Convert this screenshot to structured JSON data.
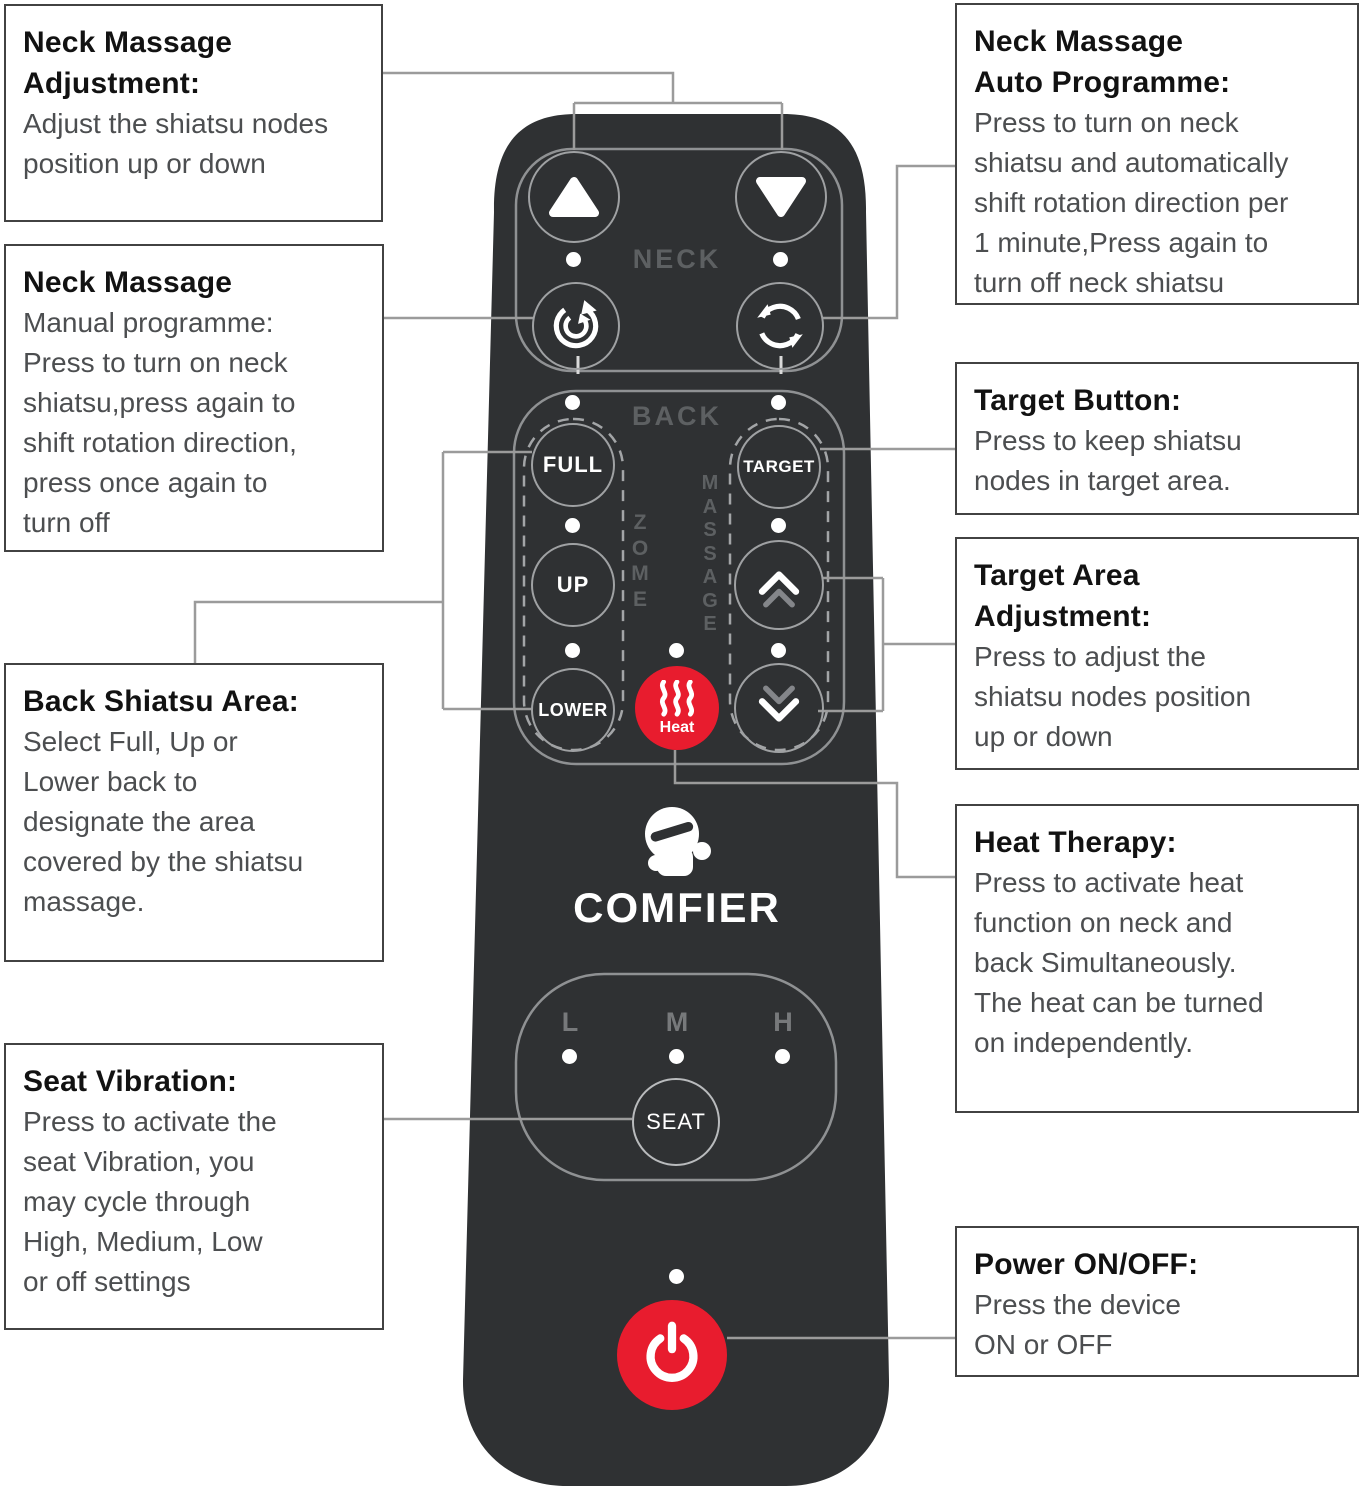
{
  "callouts": {
    "neck_adjustment": {
      "title": "Neck Massage\nAdjustment:",
      "body": "Adjust the shiatsu nodes\nposition up or down"
    },
    "neck_manual": {
      "title": "Neck Massage",
      "body": "Manual programme:\nPress to turn on neck\nshiatsu,press again to\nshift rotation direction,\npress once again to\nturn off"
    },
    "back_shiatsu": {
      "title": "Back Shiatsu Area:",
      "body": "Select Full, Up or\nLower back to\ndesignate the area\ncovered by the shiatsu\nmassage."
    },
    "seat_vibration": {
      "title": "Seat Vibration:",
      "body": "Press to activate the\nseat Vibration, you\nmay cycle through\nHigh, Medium, Low\nor off settings"
    },
    "neck_auto": {
      "title": "Neck Massage\nAuto Programme:",
      "body": "Press to turn on neck\nshiatsu and automatically\nshift rotation direction per\n1 minute,Press again to\nturn off neck shiatsu"
    },
    "target_button": {
      "title": "Target Button:",
      "body": "Press to keep shiatsu\nnodes in target area."
    },
    "target_area": {
      "title": "Target Area\nAdjustment:",
      "body": "Press to adjust the\nshiatsu nodes position\nup or down"
    },
    "heat_therapy": {
      "title": "Heat Therapy:",
      "body": "Press to activate heat\nfunction on neck and\nback Simultaneously.\nThe heat can be turned\non independently."
    },
    "power": {
      "title": "Power ON/OFF:",
      "body": "Press the device\nON or OFF"
    }
  },
  "remote": {
    "brand": "COMFIER",
    "neck_label": "NECK",
    "back_label": "BACK",
    "zone_vertical": "Z\nO\nM\nE",
    "massage_vertical": "M\nA\nS\nS\nA\nG\nE",
    "buttons": {
      "full": "FULL",
      "target": "TARGET",
      "up": "UP",
      "lower": "LOWER",
      "heat": "Heat",
      "seat": "SEAT"
    },
    "seat_levels": {
      "low": "L",
      "medium": "M",
      "high": "H"
    }
  },
  "colors": {
    "remote_body": "#2f3133",
    "accent_red": "#e81c2e",
    "button_outline": "#9fa1a3",
    "connector_gray": "#9b9b9b",
    "label_gray": "#5d6062"
  },
  "icons": [
    "triangle-up-icon",
    "triangle-down-icon",
    "rotate-cw-icon",
    "rotate-ccw-icon",
    "double-chevron-up-icon",
    "double-chevron-down-icon",
    "heat-waves-icon",
    "power-icon",
    "comfier-mascot-icon",
    "led-dot"
  ]
}
